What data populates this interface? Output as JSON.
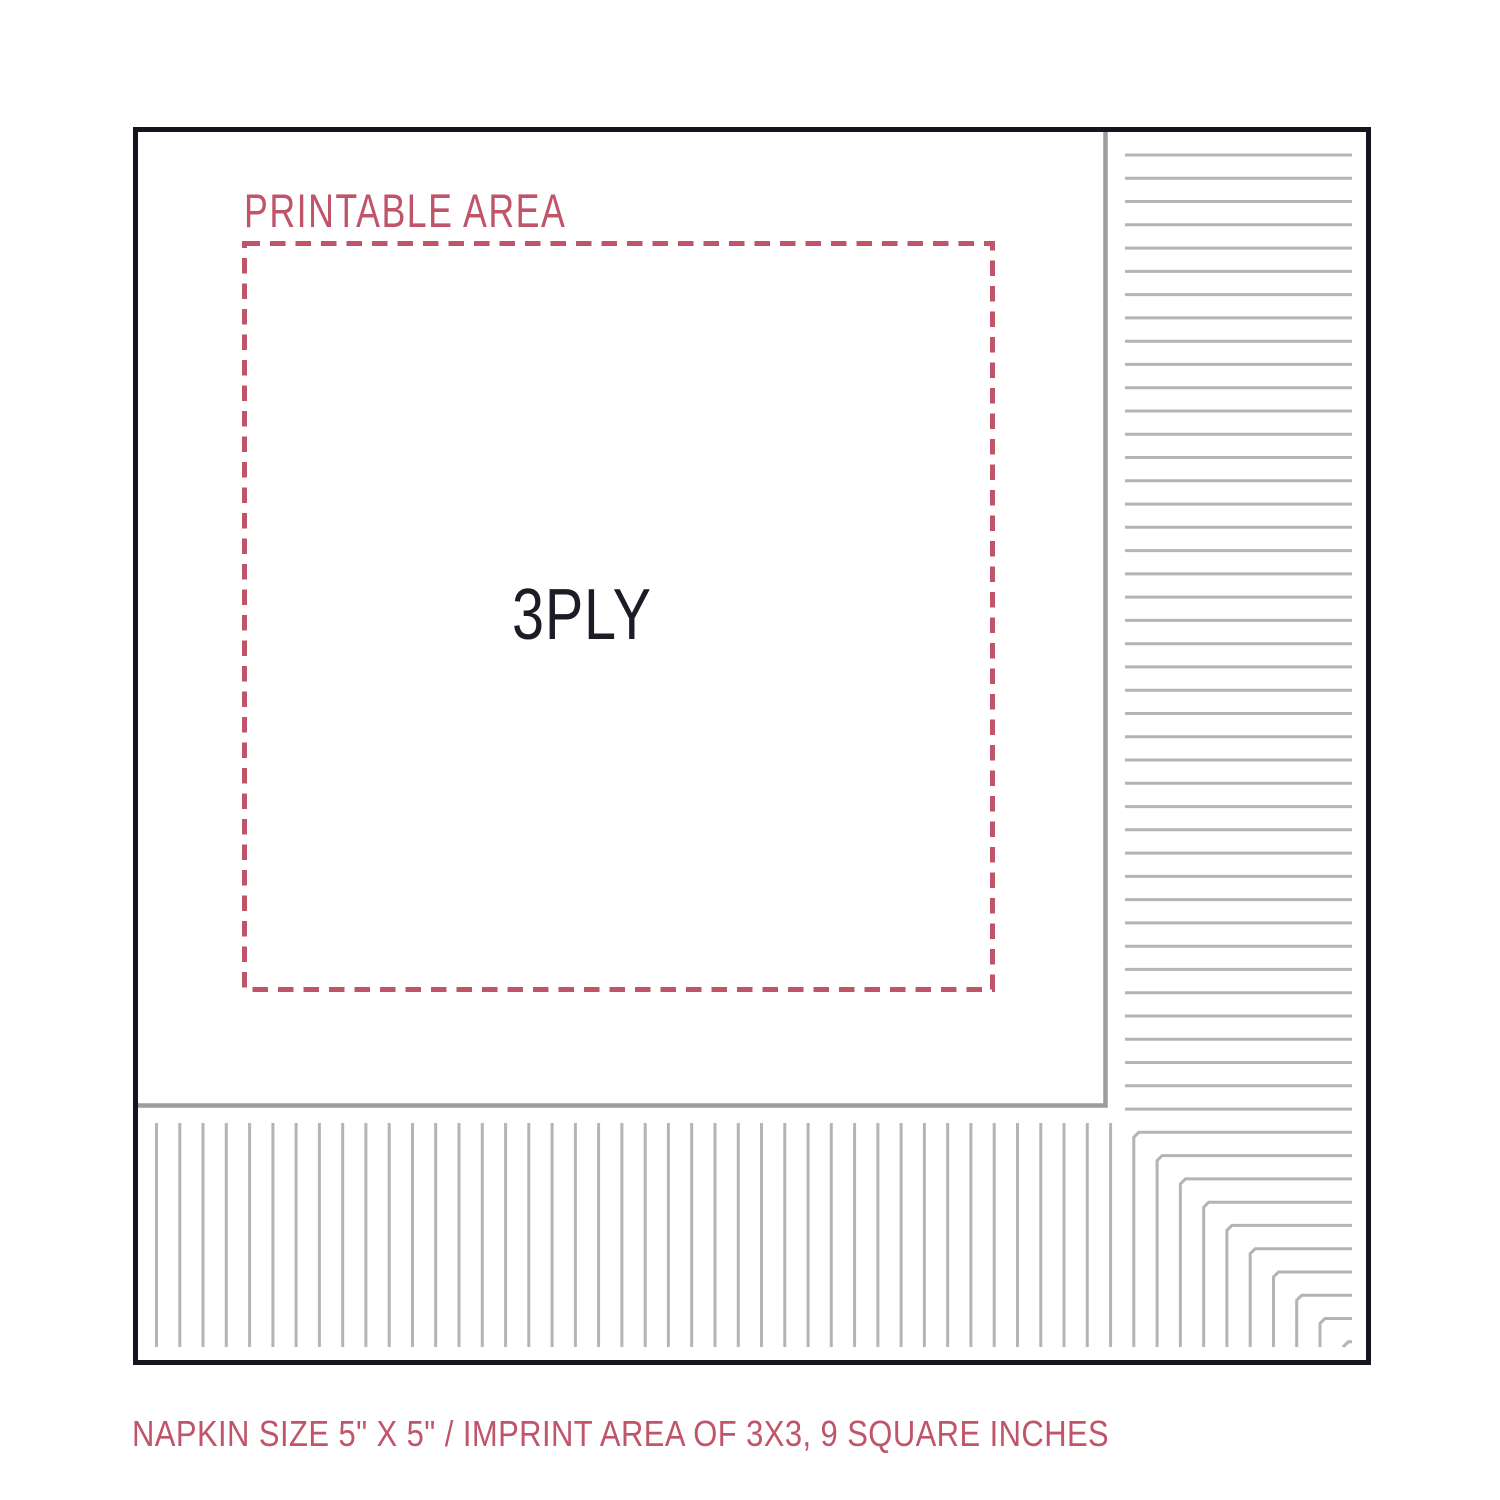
{
  "diagram": {
    "printable_area_label": "PRINTABLE AREA",
    "ply_label": "3PLY",
    "caption": "NAPKIN SIZE 5\" X 5\" / IMPRINT AREA OF 3X3, 9 SQUARE INCHES"
  },
  "colors": {
    "accent_pink": "#c05469",
    "text_dark": "#1c1b26",
    "border_dark": "#16151d",
    "fold_gray": "#9c9c9c",
    "stripe_gray": "#b4b4b4",
    "background": "#ffffff"
  }
}
